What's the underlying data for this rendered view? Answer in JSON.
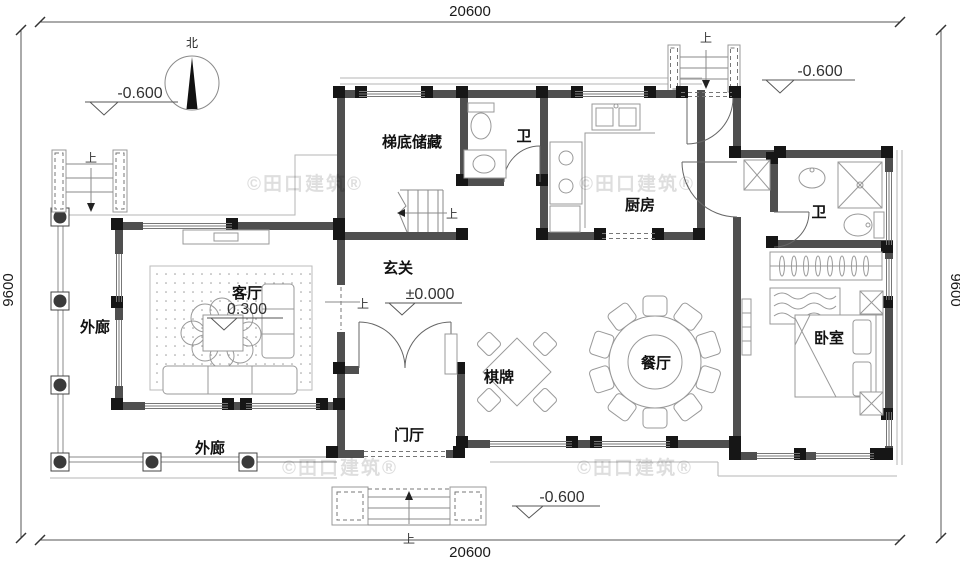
{
  "plan": {
    "watermark": "©田口建筑®",
    "north": "北",
    "up": "上",
    "dims": {
      "top": "20600",
      "bottom": "20600",
      "left": "9600",
      "right": "9600"
    },
    "elev": {
      "top_left": "-0.600",
      "top_right": "-0.600",
      "entry": "±0.000",
      "living": "0.300",
      "bottom": "-0.600"
    },
    "rooms": {
      "stair_storage": "梯底储藏",
      "bath_top": "卫",
      "kitchen": "厨房",
      "entry_hall": "玄关",
      "living": "客厅",
      "veranda_left": "外廊",
      "veranda_bottom": "外廊",
      "games": "棋牌",
      "dining": "餐厅",
      "bedroom": "卧室",
      "foyer": "门厅",
      "bath_right": "卫"
    },
    "colors": {
      "wall": "#4f4f4f",
      "column": "#161616",
      "furniture_line": "#999999",
      "background": "#ffffff"
    }
  }
}
